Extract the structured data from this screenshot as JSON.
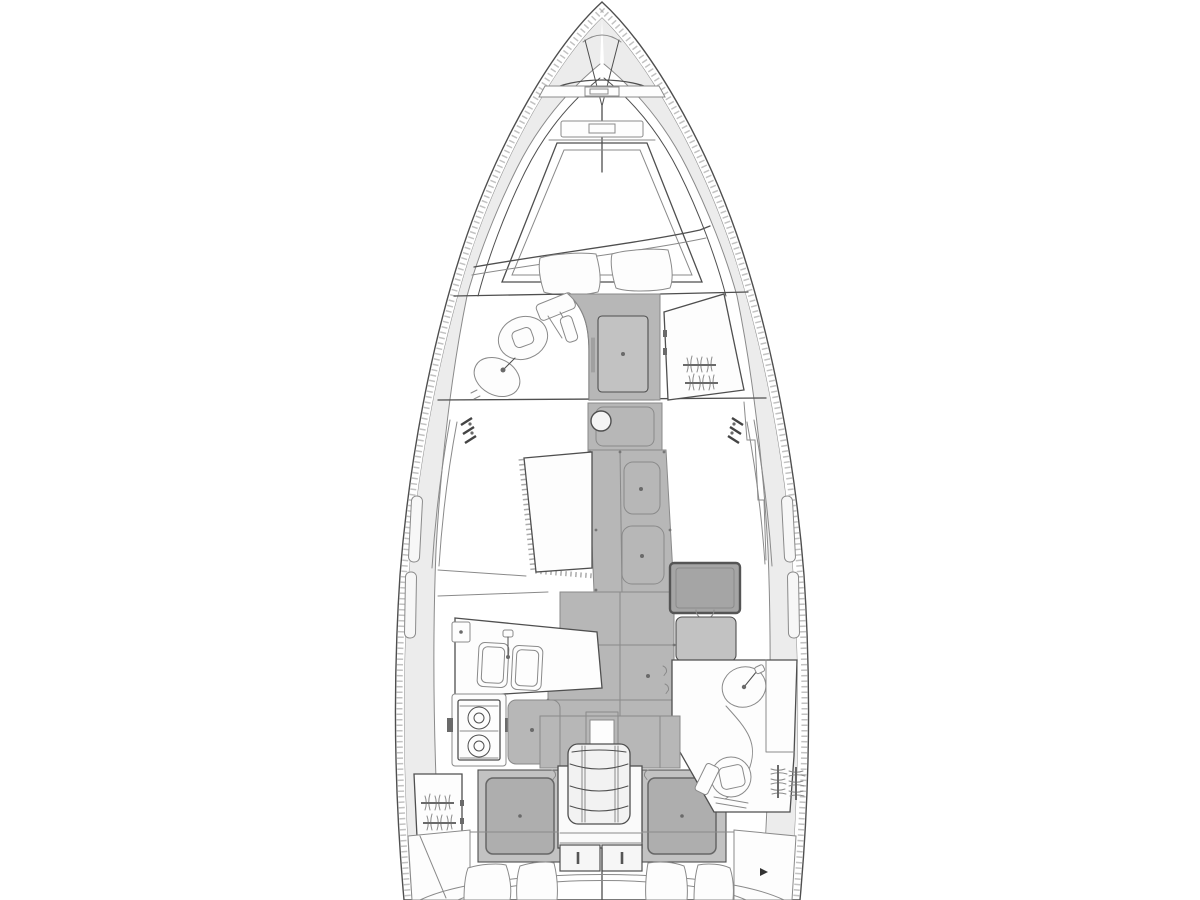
{
  "page": {
    "title": "Sailing yacht interior layout plan — top view line drawing",
    "background": "#ffffff"
  },
  "colors": {
    "line": "#4f4f4f",
    "line-soft": "#8a8a8a",
    "deck": "#ececec",
    "sole": "#b7b7b7",
    "panel": "#c2c2c2",
    "mattress": "#aeaeae",
    "table-dark": "#a5a5a5",
    "white": "#fdfdfd",
    "bg": "#ffffff"
  },
  "drawing": {
    "type": "yacht-floor-plan",
    "orientation": "bow-up",
    "features": [
      {
        "id": "bow-fitting",
        "label": "Bow anchor fitting and forestay"
      },
      {
        "id": "foredeck-hatch",
        "label": "Foredeck hatch"
      },
      {
        "id": "v-berth",
        "label": "Forward cabin V-berth with two pillows"
      },
      {
        "id": "forward-head",
        "label": "Forward head with toilet and wash basin"
      },
      {
        "id": "forward-cabin-door",
        "label": "Forward cabin door"
      },
      {
        "id": "forward-wardrobe",
        "label": "Forward starboard hanging locker"
      },
      {
        "id": "mast-post",
        "label": "Mast compression post"
      },
      {
        "id": "saloon-table",
        "label": "Saloon dinette table, port side"
      },
      {
        "id": "saloon-sole",
        "label": "Saloon cabin sole with floorboards"
      },
      {
        "id": "nav-table",
        "label": "Navigation table and seat, starboard side"
      },
      {
        "id": "galley",
        "label": "Galley with double sink and two-burner stove, port side"
      },
      {
        "id": "aft-head",
        "label": "Aft head with toilet and wash basin, starboard side"
      },
      {
        "id": "companionway",
        "label": "Companionway steps"
      },
      {
        "id": "engine-hatch",
        "label": "Engine compartment doors under the steps"
      },
      {
        "id": "aft-cabin-port",
        "label": "Port aft cabin double berth"
      },
      {
        "id": "aft-cabin-starboard",
        "label": "Starboard aft cabin double berth"
      },
      {
        "id": "hanging-lockers",
        "label": "Hanging lockers with clothes-rail symbols"
      },
      {
        "id": "hull-windows",
        "label": "Hull windows"
      },
      {
        "id": "cockpit",
        "label": "Cockpit with seat cushions"
      }
    ]
  }
}
